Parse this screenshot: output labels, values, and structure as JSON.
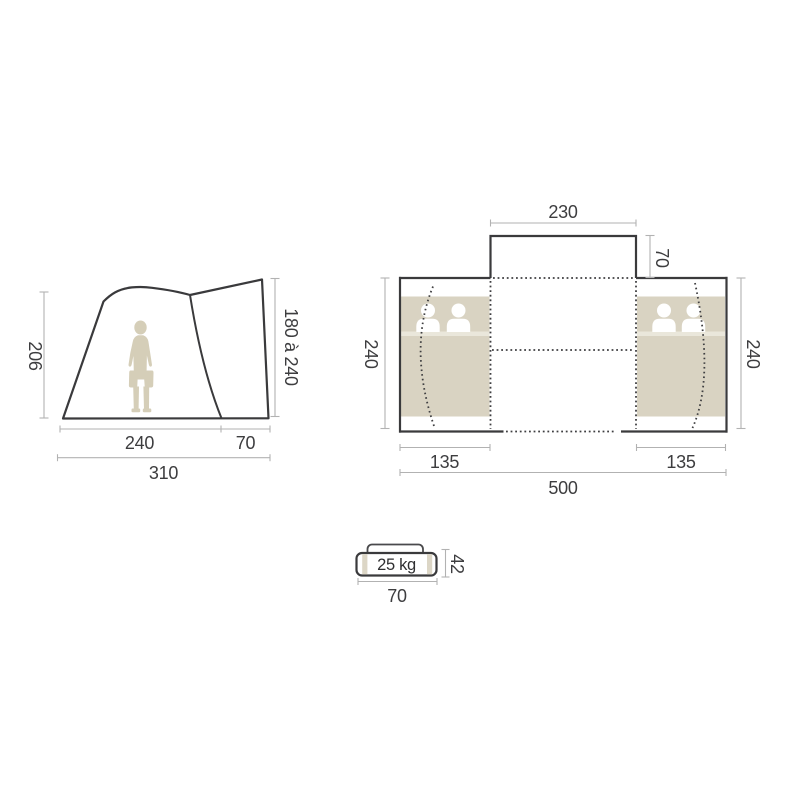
{
  "diagram": {
    "side_view": {
      "height_left_cm": "206",
      "height_right_cm": "180 à 240",
      "width_main_cm": "240",
      "width_porch_cm": "70",
      "width_total_cm": "310"
    },
    "floor_plan": {
      "canopy_width_cm": "230",
      "canopy_depth_cm": "70",
      "depth_left_cm": "240",
      "depth_right_cm": "240",
      "bedroom_left_width_cm": "135",
      "bedroom_right_width_cm": "135",
      "width_total_cm": "500"
    },
    "carry_bag": {
      "weight_label": "25 kg",
      "height_cm": "42",
      "width_cm": "70"
    },
    "colors": {
      "outline_dark": "#3a3a3c",
      "dotted_line": "#3f3f41",
      "dimension_line": "#b2b2b2",
      "dimension_text": "#3d3d3f",
      "bedroom_beige": "#d9d3c2",
      "mat_highlight": "#eae7db",
      "sleeper_white": "#ffffff",
      "person_beige": "#d5ceb8",
      "background": "#ffffff"
    }
  }
}
